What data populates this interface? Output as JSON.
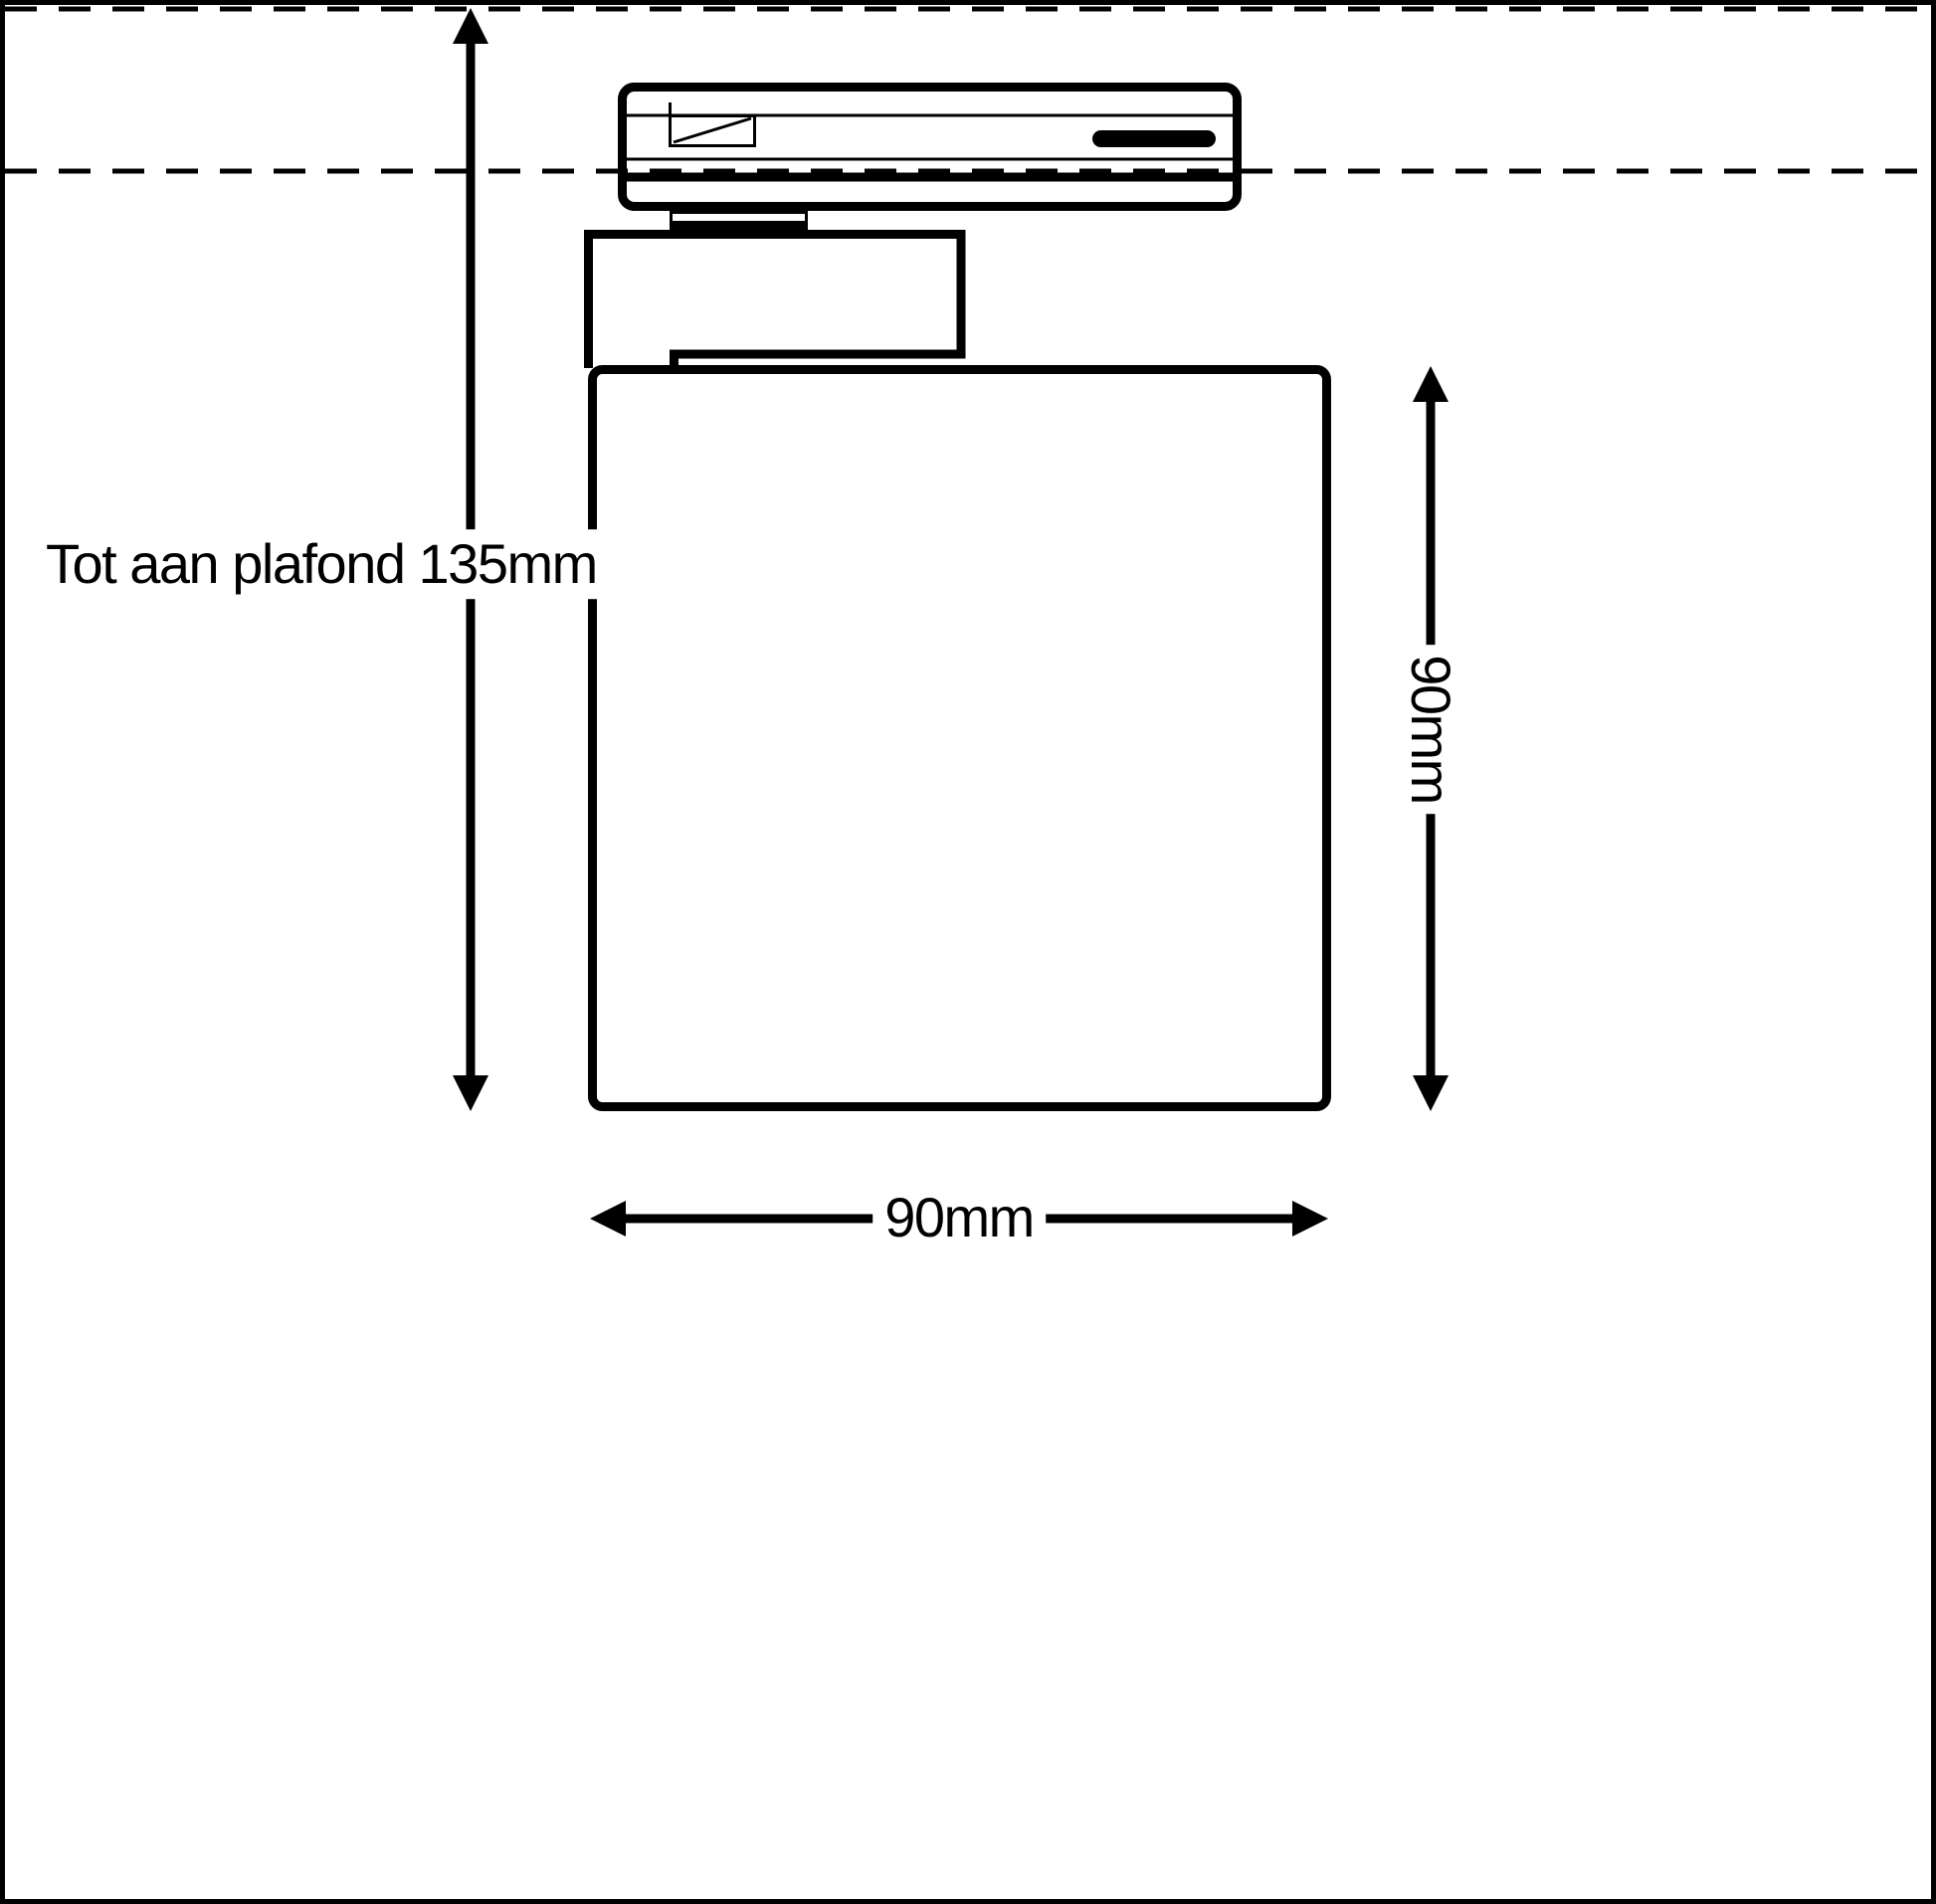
{
  "page": {
    "background_color": "#ffffff",
    "line_color": "#000000"
  },
  "labels": {
    "ceiling_distance": "Tot aan plafond 135mm",
    "height": "90mm",
    "width": "90mm"
  }
}
